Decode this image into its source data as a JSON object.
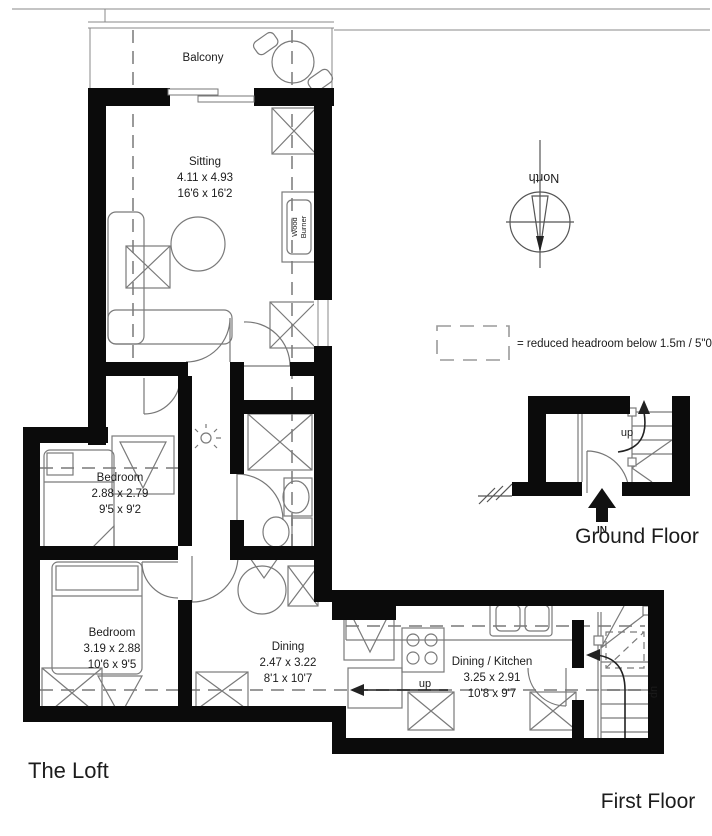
{
  "plan": {
    "title": "The Loft",
    "floor_label": "First Floor",
    "ground_floor_label": "Ground Floor",
    "legend_text": "= reduced headroom below 1.5m / 5\"0",
    "compass_label": "North",
    "rooms": {
      "balcony": {
        "name": "Balcony"
      },
      "sitting": {
        "name": "Sitting",
        "metric": "4.11 x 4.93",
        "imperial": "16'6 x 16'2"
      },
      "bedroom1": {
        "name": "Bedroom",
        "metric": "2.88 x 2.79",
        "imperial": "9'5 x 9'2"
      },
      "bedroom2": {
        "name": "Bedroom",
        "metric": "3.19 x 2.88",
        "imperial": "10'6 x 9'5"
      },
      "dining": {
        "name": "Dining",
        "metric": "2.47 x 3.22",
        "imperial": "8'1 x 10'7"
      },
      "dining_kitchen": {
        "name": "Dining / Kitchen",
        "metric": "3.25 x 2.91",
        "imperial": "10'8 x 9'7"
      }
    },
    "annotations": {
      "wood_burner_line1": "Wood",
      "wood_burner_line2": "Burner",
      "up": "up",
      "in": "IN"
    },
    "colors": {
      "wall": "#0b0b0b",
      "line": "#666666",
      "dash": "#9a9a9a"
    }
  }
}
